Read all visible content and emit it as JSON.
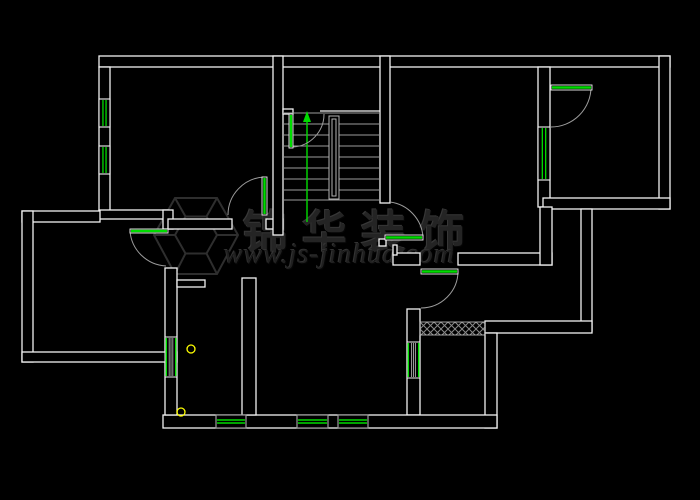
{
  "canvas": {
    "width": 700,
    "height": 500,
    "background": "#000000"
  },
  "colors": {
    "wall": "#f2f2f2",
    "fixture_green": "#00dc00",
    "detail_gray": "#9c9c9c",
    "rail_gray": "#b4b4b4",
    "plumbing_yellow": "#ffff00",
    "hatch_gray": "#8a8a8a",
    "watermark_gray": "#242424"
  },
  "watermark": {
    "company": "锦华装饰",
    "website": "www.js-jinhua.com"
  },
  "floorplan": {
    "walls": [
      {
        "x": 99,
        "y": 56,
        "w": 571,
        "h": 11
      },
      {
        "x": 99,
        "y": 67,
        "w": 11,
        "h": 151
      },
      {
        "x": 99,
        "y": 210,
        "w": 69,
        "h": 9
      },
      {
        "x": 163,
        "y": 210,
        "w": 10,
        "h": 19
      },
      {
        "x": 168,
        "y": 219,
        "w": 64,
        "h": 10
      },
      {
        "x": 266,
        "y": 219,
        "w": 17,
        "h": 10
      },
      {
        "x": 273,
        "y": 56,
        "w": 10,
        "h": 179
      },
      {
        "x": 283,
        "y": 109,
        "w": 10,
        "h": 5
      },
      {
        "x": 380,
        "y": 56,
        "w": 10,
        "h": 147
      },
      {
        "x": 538,
        "y": 67,
        "w": 12,
        "h": 140
      },
      {
        "x": 659,
        "y": 56,
        "w": 11,
        "h": 153
      },
      {
        "x": 543,
        "y": 198,
        "w": 127,
        "h": 11
      },
      {
        "x": 581,
        "y": 209,
        "w": 11,
        "h": 122
      },
      {
        "x": 485,
        "y": 321,
        "w": 107,
        "h": 12
      },
      {
        "x": 407,
        "y": 309,
        "w": 13,
        "h": 106
      },
      {
        "x": 485,
        "y": 333,
        "w": 12,
        "h": 95
      },
      {
        "x": 163,
        "y": 415,
        "w": 334,
        "h": 13
      },
      {
        "x": 165,
        "y": 268,
        "w": 12,
        "h": 147
      },
      {
        "x": 22,
        "y": 211,
        "w": 78,
        "h": 11
      },
      {
        "x": 22,
        "y": 211,
        "w": 11,
        "h": 151
      },
      {
        "x": 22,
        "y": 352,
        "w": 155,
        "h": 10
      },
      {
        "x": 177,
        "y": 280,
        "w": 28,
        "h": 7
      },
      {
        "x": 242,
        "y": 278,
        "w": 14,
        "h": 137
      },
      {
        "x": 393,
        "y": 253,
        "w": 27,
        "h": 12
      },
      {
        "x": 458,
        "y": 253,
        "w": 94,
        "h": 12
      },
      {
        "x": 540,
        "y": 207,
        "w": 12,
        "h": 58
      },
      {
        "x": 379,
        "y": 239,
        "w": 7,
        "h": 7
      },
      {
        "x": 393,
        "y": 245,
        "w": 4,
        "h": 10
      }
    ],
    "windows_mullion": [
      {
        "x": 99,
        "y": 99,
        "w": 11,
        "h": 28
      },
      {
        "x": 99,
        "y": 146,
        "w": 11,
        "h": 28
      },
      {
        "x": 538,
        "y": 127,
        "w": 12,
        "h": 53
      }
    ],
    "windows_edge": [
      {
        "x": 407,
        "y": 342,
        "w": 13,
        "h": 36
      },
      {
        "x": 165,
        "y": 337,
        "w": 12,
        "h": 40
      }
    ],
    "windows_sill": [
      {
        "x": 216,
        "y": 415,
        "w": 30,
        "h": 13
      },
      {
        "x": 297,
        "y": 415,
        "w": 31,
        "h": 13
      },
      {
        "x": 338,
        "y": 415,
        "w": 30,
        "h": 13
      }
    ],
    "doors": [
      {
        "name": "stairwell-door",
        "leaf": {
          "x": 289,
          "y": 114,
          "w": 4,
          "h": 34
        },
        "arc": "M 293 147 A 33 33 0 0 0 324 114"
      },
      {
        "name": "bedroom-top-left-door",
        "leaf": {
          "x": 262,
          "y": 177,
          "w": 5,
          "h": 38
        },
        "arc": "M 264 177 A 38 38 0 0 0 228 215"
      },
      {
        "name": "hall-door",
        "leaf": {
          "x": 385,
          "y": 235,
          "w": 38,
          "h": 5
        },
        "arc": "M 423 237 A 38 38 0 0 0 390 202"
      },
      {
        "name": "terrace-door",
        "leaf": {
          "x": 421,
          "y": 269,
          "w": 37,
          "h": 5
        },
        "arc": "M 458 271 A 37 37 0 0 1 421 308"
      },
      {
        "name": "side-room-door",
        "leaf": {
          "x": 130,
          "y": 229,
          "w": 38,
          "h": 4
        },
        "arc": "M 130 231 A 38 38 0 0 0 166 266"
      },
      {
        "name": "bedroom-top-right-door",
        "leaf": {
          "x": 551,
          "y": 85,
          "w": 41,
          "h": 5
        },
        "arc": "M 591 87 A 40 40 0 0 1 551 127"
      }
    ],
    "stairs": {
      "x1": 283,
      "x2": 380,
      "tread_ys": [
        113,
        124,
        135,
        146,
        157,
        168,
        179,
        190,
        200
      ],
      "landing": {
        "x1": 320,
        "y": 111,
        "x2": 380
      },
      "rail_outer": {
        "x": 329,
        "y": 116,
        "w": 10,
        "h": 83
      },
      "rail_inner": {
        "x": 332,
        "y": 119,
        "w": 4,
        "h": 77
      },
      "arrow": {
        "x": 307,
        "y1": 222,
        "y2": 118
      },
      "arrow_head": [
        [
          307,
          111
        ],
        [
          303,
          122
        ],
        [
          311,
          122
        ]
      ]
    },
    "hatch": {
      "x": 420,
      "y": 322,
      "w": 65,
      "h": 13
    },
    "drains": [
      {
        "cx": 191,
        "cy": 349,
        "r": 4
      },
      {
        "cx": 181,
        "cy": 412,
        "r": 4
      }
    ]
  }
}
